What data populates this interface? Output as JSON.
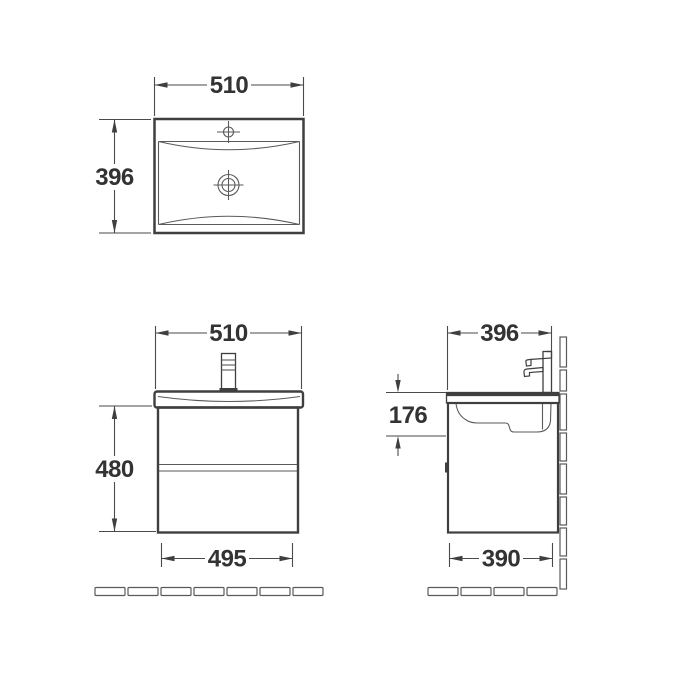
{
  "drawing": {
    "colors": {
      "line": "#3f3f3f",
      "dim_line": "#4a4a4a",
      "text": "#333333",
      "background": "#ffffff"
    },
    "top_view": {
      "width": "510",
      "depth": "396"
    },
    "front_view": {
      "width": "510",
      "height": "480",
      "base_width": "495"
    },
    "side_view": {
      "depth": "396",
      "basin_height": "176",
      "base_depth": "390"
    }
  }
}
